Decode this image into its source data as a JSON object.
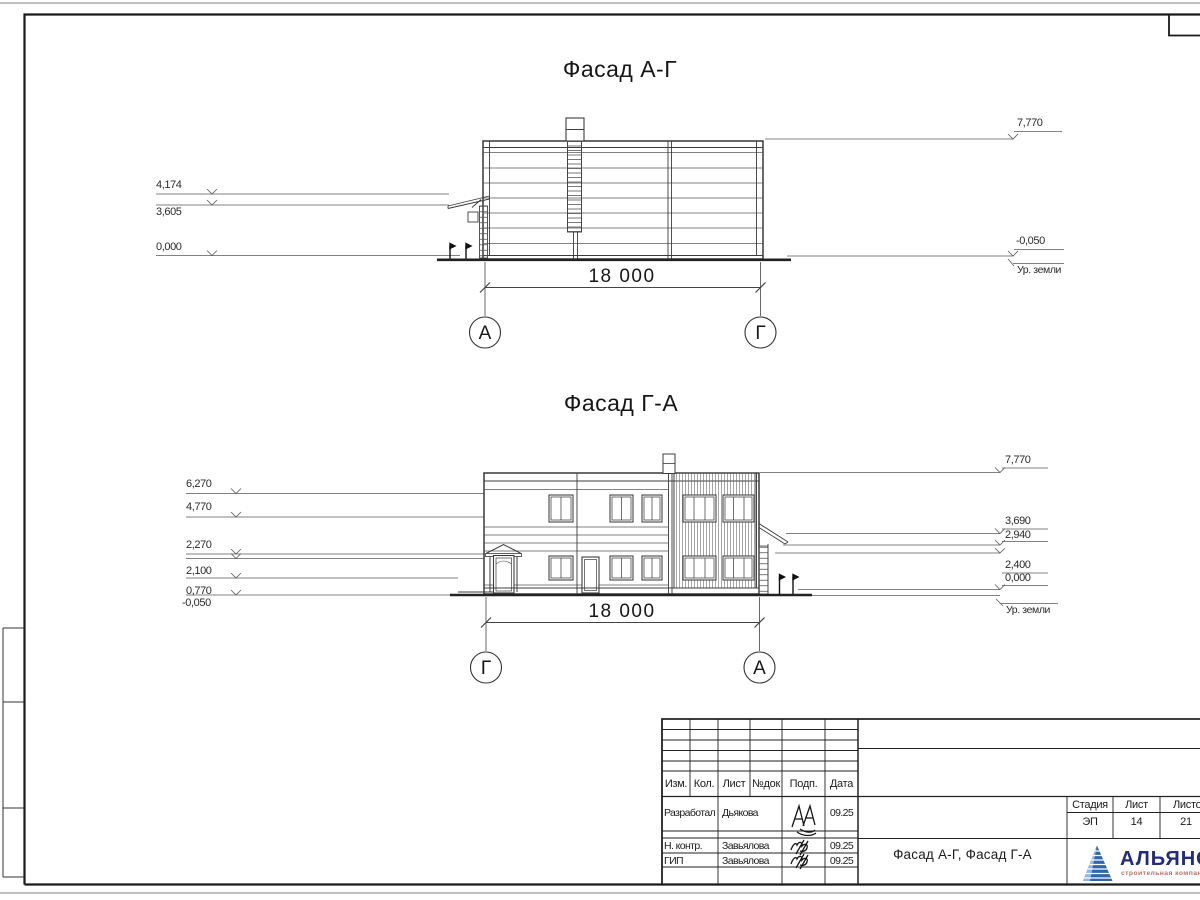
{
  "sheet": {
    "facade1": {
      "title": "Фасад А-Г",
      "marks_left": [
        "4,174",
        "3,605",
        "0,000"
      ],
      "marks_right": [
        "7,770",
        "-0,050"
      ],
      "ground_label": "Ур. земли",
      "dimension": "18 000",
      "axis_left": "А",
      "axis_right": "Г"
    },
    "facade2": {
      "title": "Фасад Г-А",
      "marks_left": [
        "6,270",
        "4,770",
        "2,270",
        "2,100",
        "0,770",
        "-0,050"
      ],
      "marks_right": [
        "7,770",
        "3,690",
        "2,940",
        "2,400",
        "0,000"
      ],
      "ground_label": "Ур. земли",
      "dimension": "18 000",
      "axis_left": "Г",
      "axis_right": "А"
    },
    "title_block": {
      "columns": [
        "Изм.",
        "Кол.",
        "Лист",
        "№док",
        "Подп.",
        "Дата"
      ],
      "rows": [
        {
          "role": "Разработал",
          "name": "Дьякова",
          "date": "09.25"
        },
        {
          "role": "Н. контр.",
          "name": "Завьялова",
          "date": "09.25"
        },
        {
          "role": "ГИП",
          "name": "Завьялова",
          "date": "09.25"
        }
      ],
      "doc_title": "Фасад А-Г, Фасад Г-А",
      "stage": {
        "headers": [
          "Стадия",
          "Лист",
          "Листов"
        ],
        "values": [
          "ЭП",
          "14",
          "21"
        ]
      },
      "logo": {
        "name": "АЛЬЯНС",
        "subtitle": "строительная компания",
        "name_color": "#232b7c",
        "subtitle_color": "#b5706a",
        "pyramid_color": "#2e66ab",
        "pyramid_light": "#8fb9e0"
      }
    }
  }
}
